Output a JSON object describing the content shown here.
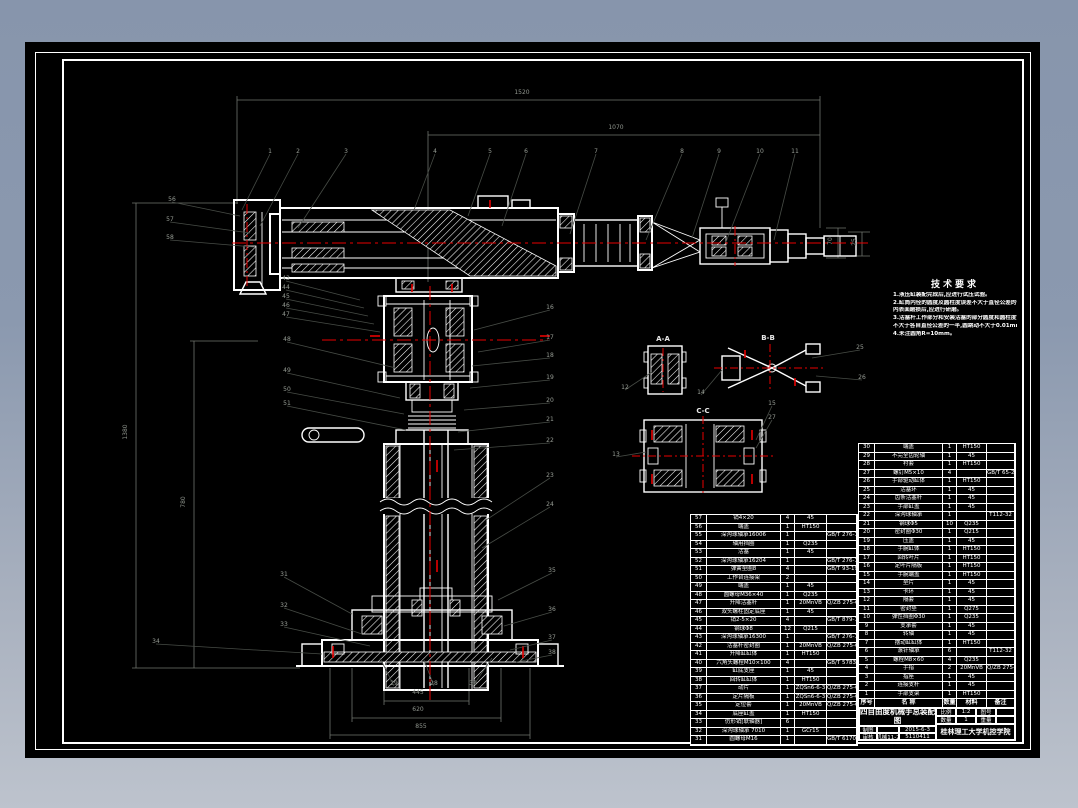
{
  "palette": {
    "desktop_top": "#8795ac",
    "desktop_bottom": "#bdc3cd",
    "sheet": "#000000",
    "line": "#ffffff",
    "centerline": "#e80000",
    "leader": "#474c46"
  },
  "tech_requirements": {
    "title": "技术要求",
    "lines": [
      "1.液压缸装配完成后,应进行试压试验。",
      "2.缸筒内径的圆度及圆柱度误差不大于直径公差的一半,",
      "  内表面磨损后,应进行研磨。",
      "3.活塞杆工作部分和安装活塞的部分圆度和圆柱度误差",
      "  不大于各自直径公差的一半,圆跳动不大于0.01mm。",
      "4.未注圆角R=10mm。"
    ]
  },
  "views": [
    {
      "label": "A-A",
      "x": 663,
      "y": 339
    },
    {
      "label": "B-B",
      "x": 768,
      "y": 338
    },
    {
      "label": "C-C",
      "x": 703,
      "y": 411
    }
  ],
  "dimensions": [
    {
      "v": "1520",
      "x": 522,
      "y": 93
    },
    {
      "v": "1070",
      "x": 616,
      "y": 128
    },
    {
      "v": "1380",
      "x": 126,
      "y": 432,
      "rot": -90
    },
    {
      "v": "780",
      "x": 184,
      "y": 502,
      "rot": -90
    },
    {
      "v": "445",
      "x": 418,
      "y": 693
    },
    {
      "v": "620",
      "x": 418,
      "y": 710
    },
    {
      "v": "855",
      "x": 421,
      "y": 727
    },
    {
      "v": "70",
      "x": 831,
      "y": 241,
      "rot": -90
    },
    {
      "v": "25",
      "x": 855,
      "y": 242,
      "rot": -90
    }
  ],
  "balloons": [
    {
      "n": "1",
      "x": 270,
      "y": 152,
      "tx": 242,
      "ty": 210
    },
    {
      "n": "2",
      "x": 298,
      "y": 152,
      "tx": 260,
      "ty": 226
    },
    {
      "n": "3",
      "x": 346,
      "y": 152,
      "tx": 298,
      "ty": 228
    },
    {
      "n": "4",
      "x": 435,
      "y": 152,
      "tx": 414,
      "ty": 210
    },
    {
      "n": "5",
      "x": 490,
      "y": 152,
      "tx": 468,
      "ty": 216
    },
    {
      "n": "6",
      "x": 526,
      "y": 152,
      "tx": 502,
      "ty": 226
    },
    {
      "n": "7",
      "x": 596,
      "y": 152,
      "tx": 570,
      "ty": 234
    },
    {
      "n": "8",
      "x": 682,
      "y": 152,
      "tx": 646,
      "ty": 240
    },
    {
      "n": "9",
      "x": 719,
      "y": 152,
      "tx": 692,
      "ty": 238
    },
    {
      "n": "10",
      "x": 760,
      "y": 152,
      "tx": 726,
      "ty": 242
    },
    {
      "n": "11",
      "x": 795,
      "y": 152,
      "tx": 774,
      "ty": 240
    },
    {
      "n": "56",
      "x": 172,
      "y": 200,
      "tx": 240,
      "ty": 216
    },
    {
      "n": "57",
      "x": 170,
      "y": 220,
      "tx": 250,
      "ty": 233
    },
    {
      "n": "58",
      "x": 170,
      "y": 238,
      "tx": 254,
      "ty": 247
    },
    {
      "n": "43",
      "x": 286,
      "y": 279,
      "tx": 360,
      "ty": 300
    },
    {
      "n": "44",
      "x": 286,
      "y": 288,
      "tx": 364,
      "ty": 308
    },
    {
      "n": "45",
      "x": 286,
      "y": 297,
      "tx": 368,
      "ty": 316
    },
    {
      "n": "46",
      "x": 286,
      "y": 306,
      "tx": 374,
      "ty": 324
    },
    {
      "n": "47",
      "x": 286,
      "y": 315,
      "tx": 380,
      "ty": 332
    },
    {
      "n": "48",
      "x": 287,
      "y": 340,
      "tx": 396,
      "ty": 368
    },
    {
      "n": "49",
      "x": 287,
      "y": 371,
      "tx": 400,
      "ty": 398
    },
    {
      "n": "50",
      "x": 287,
      "y": 390,
      "tx": 404,
      "ty": 414
    },
    {
      "n": "51",
      "x": 287,
      "y": 404,
      "tx": 406,
      "ty": 430
    },
    {
      "n": "31",
      "x": 284,
      "y": 575,
      "tx": 352,
      "ty": 614
    },
    {
      "n": "32",
      "x": 284,
      "y": 606,
      "tx": 362,
      "ty": 634
    },
    {
      "n": "33",
      "x": 284,
      "y": 625,
      "tx": 370,
      "ty": 646
    },
    {
      "n": "34",
      "x": 156,
      "y": 642,
      "tx": 322,
      "ty": 654
    },
    {
      "n": "16",
      "x": 550,
      "y": 308,
      "tx": 474,
      "ty": 330
    },
    {
      "n": "17",
      "x": 550,
      "y": 338,
      "tx": 478,
      "ty": 352
    },
    {
      "n": "18",
      "x": 550,
      "y": 356,
      "tx": 472,
      "ty": 366
    },
    {
      "n": "19",
      "x": 550,
      "y": 378,
      "tx": 470,
      "ty": 388
    },
    {
      "n": "20",
      "x": 550,
      "y": 401,
      "tx": 464,
      "ty": 410
    },
    {
      "n": "21",
      "x": 550,
      "y": 420,
      "tx": 458,
      "ty": 432
    },
    {
      "n": "22",
      "x": 550,
      "y": 441,
      "tx": 454,
      "ty": 450
    },
    {
      "n": "23",
      "x": 550,
      "y": 476,
      "tx": 486,
      "ty": 520
    },
    {
      "n": "24",
      "x": 550,
      "y": 505,
      "tx": 482,
      "ty": 548
    },
    {
      "n": "35",
      "x": 552,
      "y": 571,
      "tx": 498,
      "ty": 600
    },
    {
      "n": "36",
      "x": 552,
      "y": 610,
      "tx": 504,
      "ty": 626
    },
    {
      "n": "37",
      "x": 552,
      "y": 638,
      "tx": 510,
      "ty": 650
    },
    {
      "n": "38",
      "x": 552,
      "y": 653,
      "tx": 516,
      "ty": 662
    },
    {
      "n": "12",
      "x": 625,
      "y": 388,
      "tx": 652,
      "ty": 372
    },
    {
      "n": "13",
      "x": 616,
      "y": 455,
      "tx": 646,
      "ty": 452
    },
    {
      "n": "14",
      "x": 701,
      "y": 393,
      "tx": 722,
      "ty": 370
    },
    {
      "n": "15",
      "x": 772,
      "y": 404,
      "tx": 756,
      "ty": 440
    },
    {
      "n": "25",
      "x": 860,
      "y": 348,
      "tx": 812,
      "ty": 358
    },
    {
      "n": "26",
      "x": 862,
      "y": 378,
      "tx": 816,
      "ty": 376
    },
    {
      "n": "27",
      "x": 772,
      "y": 418,
      "tx": 756,
      "ty": 448
    },
    {
      "n": "29",
      "x": 394,
      "y": 684,
      "tx": 380,
      "ty": 658
    },
    {
      "n": "28",
      "x": 434,
      "y": 684,
      "tx": 424,
      "ty": 660
    },
    {
      "n": "30",
      "x": 473,
      "y": 684,
      "tx": 492,
      "ty": 658
    }
  ],
  "parts_table_left": {
    "cols": [
      16,
      74,
      14,
      32,
      30
    ],
    "row_h": 8.5,
    "rows": [
      [
        "57",
        "销4×20",
        "4",
        "45",
        ""
      ],
      [
        "56",
        "端盖",
        "1",
        "HT150",
        ""
      ],
      [
        "55",
        "深沟球轴承16006",
        "1",
        "",
        "GB/T 276-1994"
      ],
      [
        "54",
        "轴用挡圈",
        "1",
        "Q235",
        ""
      ],
      [
        "53",
        "活塞",
        "1",
        "45",
        ""
      ],
      [
        "52",
        "深沟球轴承16204",
        "1",
        "",
        "GB/T 276-1994"
      ],
      [
        "51",
        "弹簧垫圈8",
        "4",
        "",
        "GB/T 93-1987"
      ],
      [
        "50",
        "工作台连接架",
        "2",
        "",
        ""
      ],
      [
        "49",
        "端盖",
        "1",
        "45",
        ""
      ],
      [
        "48",
        "圆螺母M36×40",
        "1",
        "Q235",
        ""
      ],
      [
        "47",
        "升降活塞杆",
        "1",
        "20MnVB",
        "Q/ZB 275-62"
      ],
      [
        "46",
        "双头螺柱固定底座",
        "1",
        "45",
        ""
      ],
      [
        "45",
        "销2-5×20",
        "4",
        "",
        "GB/T 879-1994"
      ],
      [
        "44",
        "钢球Φ8",
        "12",
        "Q215",
        ""
      ],
      [
        "43",
        "深沟球轴承16300",
        "1",
        "",
        "GB/T 276-1994"
      ],
      [
        "42",
        "活塞杆密封圈",
        "1",
        "20MnVB",
        "Q/ZB 275-62"
      ],
      [
        "41",
        "升降缸缸体",
        "1",
        "HT150",
        ""
      ],
      [
        "40",
        "六角头螺栓M10×100",
        "4",
        "",
        "GB/T 5783-2000"
      ],
      [
        "39",
        "缸底支座",
        "1",
        "45",
        ""
      ],
      [
        "38",
        "回转缸缸体",
        "1",
        "HT150",
        ""
      ],
      [
        "37",
        "动片",
        "1",
        "ZQSn6-6-3",
        "Q/ZB 275-62"
      ],
      [
        "36",
        "定片隔板",
        "1",
        "ZQSn6-6-3",
        "Q/ZB 275-62"
      ],
      [
        "35",
        "定位套",
        "1",
        "20MnVB",
        "Q/ZB 275-62"
      ],
      [
        "34",
        "底座缸盖",
        "1",
        "HT150",
        ""
      ],
      [
        "33",
        "仿形销[联轴器]",
        "6",
        "",
        ""
      ],
      [
        "32",
        "深沟球轴承 7010",
        "1",
        "GCr15",
        ""
      ],
      [
        "31",
        "圆螺母M16",
        "1",
        "",
        "GB/T 6170-2000"
      ]
    ]
  },
  "parts_table_right": {
    "cols": [
      16,
      68,
      14,
      30,
      28
    ],
    "row_h": 8.5,
    "rows": [
      [
        "30",
        "端盖",
        "1",
        "HT150",
        ""
      ],
      [
        "29",
        "不完全齿轮轴",
        "1",
        "45",
        ""
      ],
      [
        "28",
        "衬套",
        "1",
        "HT150",
        ""
      ],
      [
        "27",
        "螺钉M5×10",
        "4",
        "",
        "GB/T 65-2000"
      ],
      [
        "26",
        "手部驱动缸体",
        "1",
        "HT150",
        ""
      ],
      [
        "25",
        "活塞环",
        "1",
        "45",
        ""
      ],
      [
        "24",
        "齿条活塞杆",
        "1",
        "45",
        ""
      ],
      [
        "23",
        "手部缸盖",
        "1",
        "45",
        ""
      ],
      [
        "22",
        "深沟球轴承",
        "1",
        "",
        "T112-32"
      ],
      [
        "21",
        "钢球Φ5",
        "10",
        "Q235",
        ""
      ],
      [
        "20",
        "密封圈Φ30",
        "1",
        "Q215",
        ""
      ],
      [
        "19",
        "压盖",
        "1",
        "45",
        ""
      ],
      [
        "18",
        "手腕缸体",
        "1",
        "HT150",
        ""
      ],
      [
        "17",
        "回转叶片",
        "1",
        "HT150",
        ""
      ],
      [
        "16",
        "定叶片隔板",
        "1",
        "HT150",
        ""
      ],
      [
        "15",
        "手腕端盖",
        "1",
        "HT150",
        ""
      ],
      [
        "14",
        "垫片",
        "1",
        "45",
        ""
      ],
      [
        "13",
        "卡环",
        "1",
        "45",
        ""
      ],
      [
        "12",
        "隔套",
        "1",
        "45",
        ""
      ],
      [
        "11",
        "密封垫",
        "1",
        "Q275",
        ""
      ],
      [
        "10",
        "弹性挡圈Φ30",
        "1",
        "Q235",
        ""
      ],
      [
        "9",
        "支承套",
        "1",
        "45",
        ""
      ],
      [
        "8",
        "转轴",
        "1",
        "45",
        ""
      ],
      [
        "7",
        "摆动缸缸体",
        "1",
        "HT150",
        ""
      ],
      [
        "6",
        "滚针轴承",
        "6",
        "",
        "T112-32"
      ],
      [
        "5",
        "螺栓M8×60",
        "4",
        "Q235",
        ""
      ],
      [
        "4",
        "手指",
        "2",
        "20MnVB",
        "Q/ZB 275-62"
      ],
      [
        "3",
        "指座",
        "1",
        "45",
        ""
      ],
      [
        "2",
        "连接支杆",
        "1",
        "45",
        ""
      ],
      [
        "1",
        "手部支架",
        "1",
        "HT150",
        ""
      ]
    ]
  },
  "parts_table_header": {
    "cols": [
      16,
      68,
      14,
      30,
      28
    ],
    "row_h": 9,
    "bold": true,
    "rows": [
      [
        "序号",
        "名  称",
        "数量",
        "材料",
        "备注"
      ]
    ]
  },
  "title_block": {
    "title": "四自由度机械手总装配图",
    "scale_label": "比例",
    "scale": "1:2",
    "sheet_label": "图号",
    "sheet_no": "",
    "qty_label": "数量",
    "qty": "1",
    "weight_label": "重量",
    "weight": "",
    "drafter_label": "制图",
    "drafter": "",
    "date": "2015-6-3",
    "checker_label": "审核",
    "checker_class": "机械11-2",
    "checker_no": "5110411",
    "org": "桂林理工大学机控学院"
  }
}
